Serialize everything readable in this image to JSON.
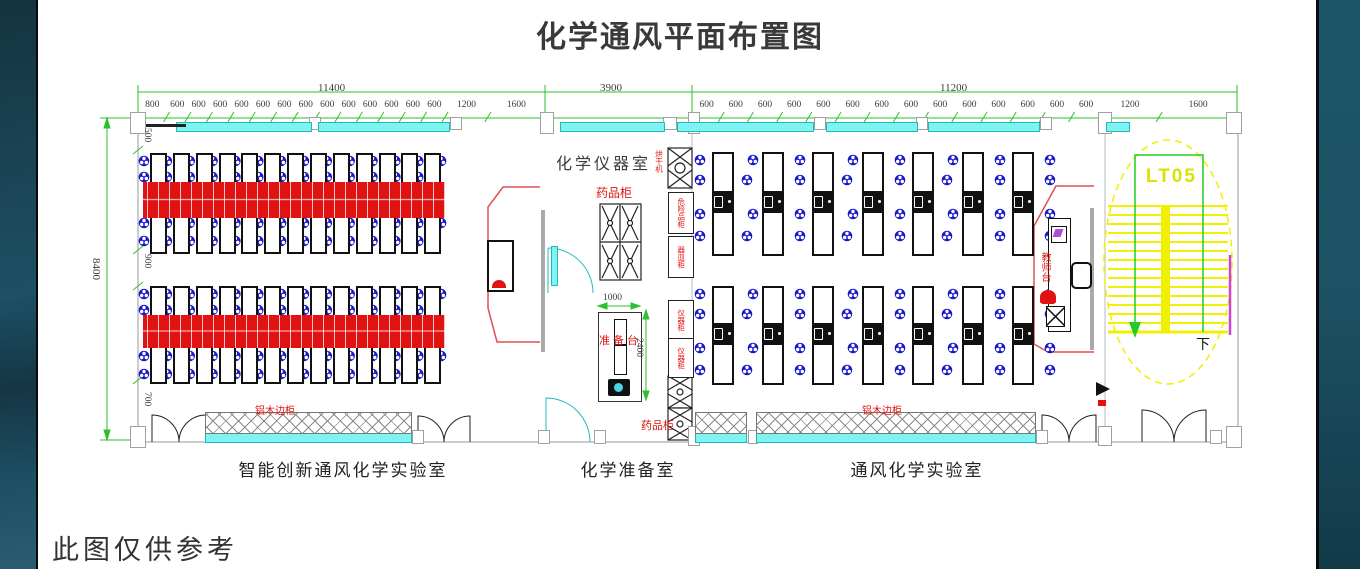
{
  "title": "化学通风平面布置图",
  "footnote": "此图仅供参考",
  "rooms": {
    "left": {
      "label": "智能创新通风化学实验室",
      "side_cabinet": "铝木边柜"
    },
    "middle": {
      "label": "化学准备室",
      "name_top": "化学仪器室",
      "medicine_cabinet_top": "药品柜",
      "medicine_cabinet_bottom": "药品柜",
      "prep_table": "准备台",
      "cabinets": {
        "oven": "烘干机",
        "hazmat": "危险品柜",
        "vessel": "器皿柜",
        "instrument1": "仪器柜",
        "instrument2": "仪器柜"
      }
    },
    "right": {
      "label": "通风化学实验室",
      "teacher_station": "教师台",
      "side_cabinet": "铝木边柜"
    }
  },
  "stairwell": {
    "code": "LT05",
    "down_label": "下"
  },
  "dimensions": {
    "left_total": "11400",
    "middle_total": "3900",
    "right_total": "11200",
    "height_total": "8400",
    "left_segments": [
      "800",
      "600",
      "600",
      "600",
      "600",
      "600",
      "600",
      "600",
      "600",
      "600",
      "600",
      "600",
      "600",
      "600",
      "1200",
      "1600"
    ],
    "right_segments": [
      "600",
      "600",
      "600",
      "600",
      "600",
      "600",
      "600",
      "600",
      "600",
      "600",
      "600",
      "600",
      "600",
      "600",
      "1200",
      "1600"
    ],
    "height_segments": [
      "500",
      "900",
      "700"
    ],
    "prep_table_width": "1000",
    "prep_table_depth": "2400"
  },
  "colors": {
    "dimension_green": "#2fbf2f",
    "window_cyan": "#7df4f2",
    "equipment_red": "#e01212",
    "bench_blue": "#1a1acc",
    "stair_yellow": "#f0f000",
    "panel_teal": "#1d4f63"
  }
}
